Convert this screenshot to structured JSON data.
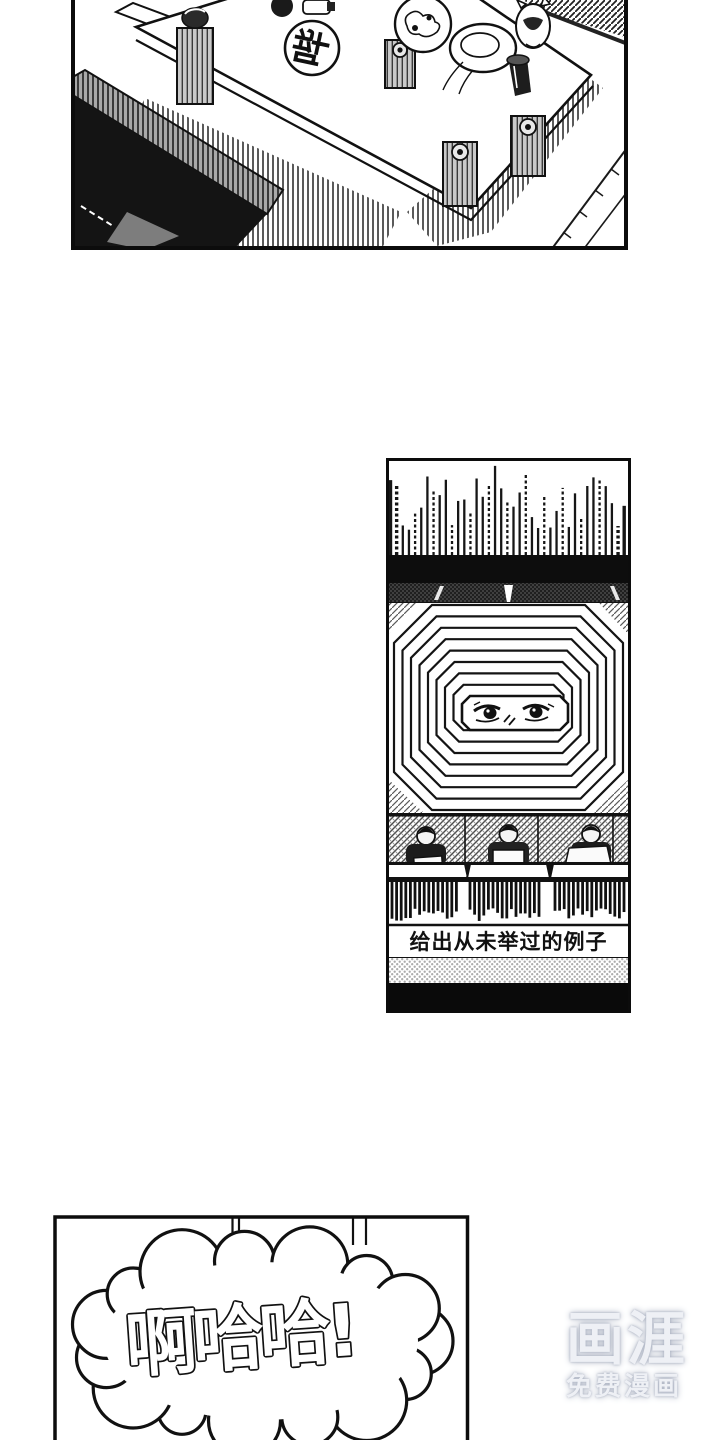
{
  "page": {
    "background": "#ffffff",
    "ink": "#111111"
  },
  "comic": {
    "panel_living_room": {
      "sfx_bubble": "哔"
    },
    "panel_tv_studio": {
      "caption": "给出从未举过的例子"
    },
    "panel_laughter": {
      "speech": "啊哈哈!"
    }
  },
  "watermark": {
    "logo": "画涯",
    "tagline": "免费漫画",
    "color": "#eef0f5",
    "glow_color": "#a9b0c0"
  }
}
